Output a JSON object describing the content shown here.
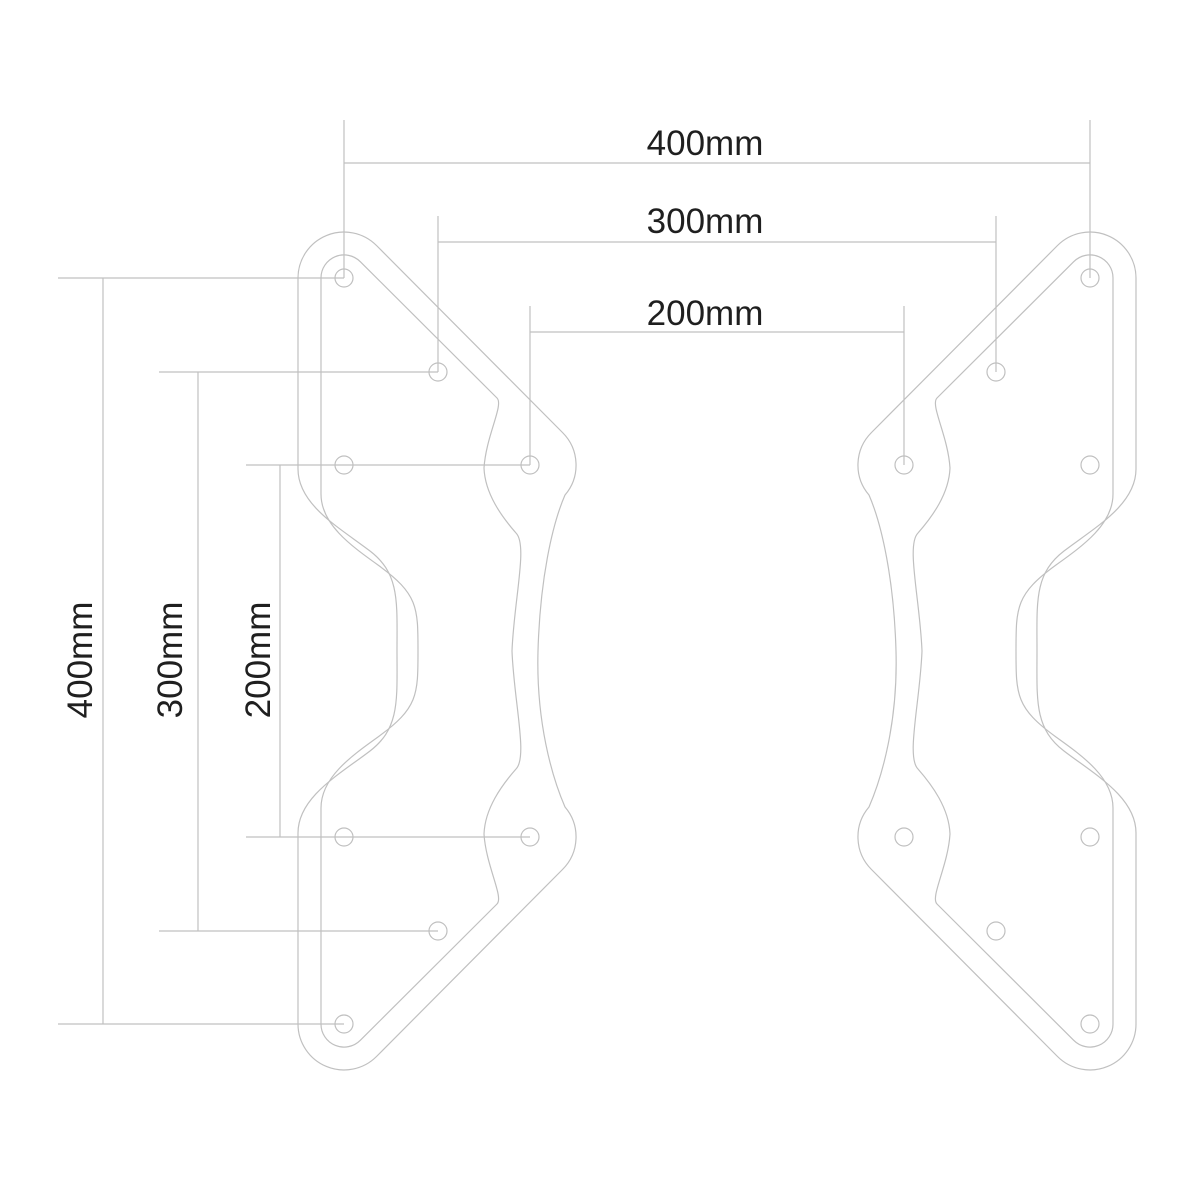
{
  "drawing": {
    "description": "VESA adapter bracket plates dimension drawing",
    "background_color": "#ffffff",
    "line_color": "#c0c0c0",
    "text_color": "#1f1f1f",
    "hole_radius": 9,
    "dimensions": {
      "horizontal": [
        {
          "label": "400mm",
          "value_mm": 400,
          "dim_line": {
            "x1": 344,
            "y1": 163,
            "x2": 1090,
            "y2": 163
          },
          "label_pos": {
            "x": 705,
            "y": 155
          },
          "extensions": [
            {
              "x1": 344,
              "y1": 120,
              "x2": 344,
              "y2": 278
            },
            {
              "x1": 1090,
              "y1": 120,
              "x2": 1090,
              "y2": 278
            }
          ]
        },
        {
          "label": "300mm",
          "value_mm": 300,
          "dim_line": {
            "x1": 438,
            "y1": 242,
            "x2": 996,
            "y2": 242
          },
          "label_pos": {
            "x": 705,
            "y": 233
          },
          "extensions": [
            {
              "x1": 438,
              "y1": 216,
              "x2": 438,
              "y2": 372
            },
            {
              "x1": 996,
              "y1": 216,
              "x2": 996,
              "y2": 372
            }
          ]
        },
        {
          "label": "200mm",
          "value_mm": 200,
          "dim_line": {
            "x1": 530,
            "y1": 332,
            "x2": 904,
            "y2": 332
          },
          "label_pos": {
            "x": 705,
            "y": 325
          },
          "extensions": [
            {
              "x1": 530,
              "y1": 306,
              "x2": 530,
              "y2": 465
            },
            {
              "x1": 904,
              "y1": 306,
              "x2": 904,
              "y2": 465
            }
          ]
        }
      ],
      "vertical": [
        {
          "label": "400mm",
          "value_mm": 400,
          "dim_line": {
            "x1": 103,
            "y1": 278,
            "x2": 103,
            "y2": 1024
          },
          "label_pos": {
            "x": 92,
            "y": 660
          },
          "extensions": [
            {
              "x1": 58,
              "y1": 278,
              "x2": 344,
              "y2": 278
            },
            {
              "x1": 58,
              "y1": 1024,
              "x2": 344,
              "y2": 1024
            }
          ]
        },
        {
          "label": "300mm",
          "value_mm": 300,
          "dim_line": {
            "x1": 198,
            "y1": 372,
            "x2": 198,
            "y2": 931
          },
          "label_pos": {
            "x": 182,
            "y": 660
          },
          "extensions": [
            {
              "x1": 159,
              "y1": 372,
              "x2": 438,
              "y2": 372
            },
            {
              "x1": 159,
              "y1": 931,
              "x2": 438,
              "y2": 931
            }
          ]
        },
        {
          "label": "200mm",
          "value_mm": 200,
          "dim_line": {
            "x1": 280,
            "y1": 465,
            "x2": 280,
            "y2": 837
          },
          "label_pos": {
            "x": 270,
            "y": 660
          },
          "extensions": [
            {
              "x1": 246,
              "y1": 465,
              "x2": 530,
              "y2": 465
            },
            {
              "x1": 246,
              "y1": 837,
              "x2": 530,
              "y2": 837
            }
          ]
        }
      ]
    },
    "plates": {
      "left": {
        "outer_path": "M 298 278 A 46 46 0 0 1 376.5 245.5 L 562.5 432.5 A 46 46 0 0 1 565 495 C 552 525 540 580 538 651 C 536 722 552 777 565 807 A 46 46 0 0 1 562.5 869.5 L 376.5 1056.5 A 46 46 0 0 1 298 1024 L 298 833 C 298 797 340 774 370 751 C 400 728 397 700 397 651 C 397 602 400 574 370 551 C 340 528 298 505 298 469 Z",
        "inner_path": "M 321 278 A 23 23 0 0 1 360.3 261.7 L 497 398 C 504 405 486 436 484 468 C 485 494 502 517 516 533 C 528 545 514 600 512 651 C 514 702 528 757 516 769 C 502 785 485 808 484 834 C 486 866 504 897 497 904 L 360.3 1040.3 A 23 23 0 0 1 321 1024 L 321 808 C 321 778 350 757 378 737 C 418 708 418 695 418 651 C 418 607 418 594 378 565 C 350 545 321 524 321 494 Z",
        "holes": [
          [
            344,
            278
          ],
          [
            438,
            372
          ],
          [
            344,
            465
          ],
          [
            530,
            465
          ],
          [
            344,
            837
          ],
          [
            530,
            837
          ],
          [
            438,
            931
          ],
          [
            344,
            1024
          ]
        ]
      },
      "right": {
        "mirrored_from": "left",
        "mirror_axis_x": 1434,
        "holes": [
          [
            1090,
            278
          ],
          [
            996,
            372
          ],
          [
            1090,
            465
          ],
          [
            904,
            465
          ],
          [
            1090,
            837
          ],
          [
            904,
            837
          ],
          [
            996,
            931
          ],
          [
            1090,
            1024
          ]
        ]
      }
    }
  }
}
